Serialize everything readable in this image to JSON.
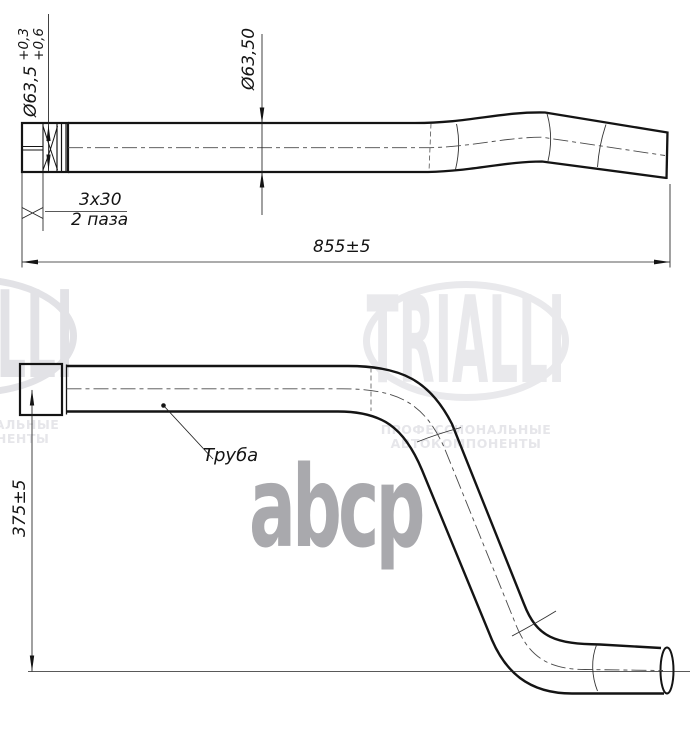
{
  "drawing": {
    "labels": {
      "dia_left_main": "Ø63,5",
      "dia_left_tol_upper": "+0,3",
      "dia_left_tol_lower": "+0,6",
      "dia_mid": "Ø63,50",
      "slot_line1": "3x30",
      "slot_line2": "2 паза",
      "length_total": "855±5",
      "height_dim": "375±5",
      "part_name": "Труба"
    }
  },
  "watermarks": {
    "brand": "TRIALLI",
    "tagline_line1": "ПРОФЕССИОНАЛЬНЫЕ",
    "tagline_line2": "АВТОКОМПОНЕНТЫ",
    "abcp": "abcp"
  },
  "colors": {
    "line": "#141414",
    "centerline": "#4a4a4a",
    "watermark_gray": "#e9e9ec",
    "abcp_gray": "#a9a9ad",
    "background": "#ffffff"
  }
}
